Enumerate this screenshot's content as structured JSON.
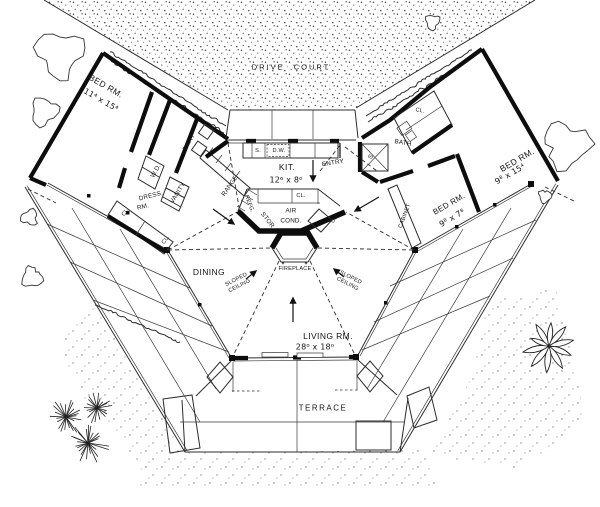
{
  "site": {
    "drive_court": "DRIVE COURT",
    "terrace": "TERRACE"
  },
  "rooms": {
    "bed_left": {
      "label": "BED RM.",
      "dims": "11⁴ x 15⁴"
    },
    "bed_right_large": {
      "label": "BED RM.",
      "dims": "9⁸ x 15⁴"
    },
    "bed_right_small": {
      "label": "BED RM.",
      "dims": "9⁸ x 7⁸"
    },
    "kitchen": {
      "label": "KIT.",
      "dims": "12⁶ x 8⁰"
    },
    "living": {
      "label": "LIVING RM.",
      "dims": "28⁰ x 18⁰"
    },
    "dining": {
      "label": "DINING"
    },
    "entry": {
      "label": "ENTRY"
    }
  },
  "features": {
    "fireplace": "FIREPLACE",
    "air": "AIR",
    "cond": "COND.",
    "stor": "STOR.",
    "refg": "REFG.",
    "bath": "BATH",
    "wd": "W.D.",
    "vanity": "VANITY",
    "range": "RANGE",
    "dress": "DRESS.",
    "rm": "RM.",
    "closet": "CL.",
    "sink": "S.",
    "dishwasher": "D.W.",
    "shower": "S",
    "cabinet": "CABINET",
    "sloped": "SLOPED",
    "ceiling": "CEILING"
  },
  "colors": {
    "ink": "#141414",
    "paper": "#ffffff"
  }
}
